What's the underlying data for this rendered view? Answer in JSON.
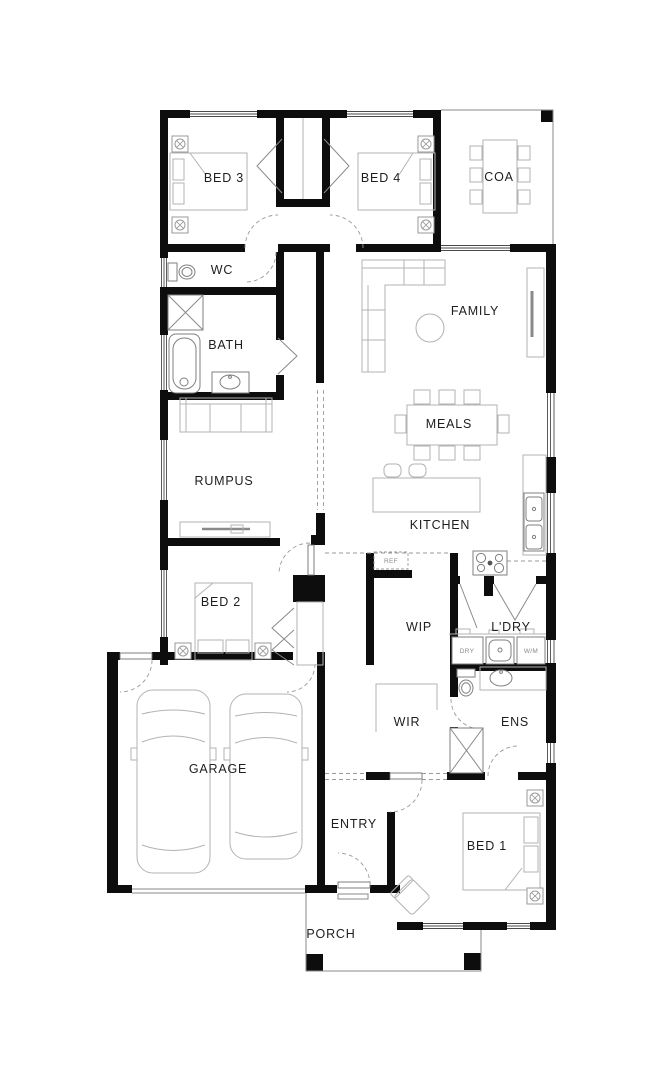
{
  "floorplan": {
    "rooms": {
      "bed3": "BED 3",
      "bed4": "BED 4",
      "coa": "COA",
      "wc": "WC",
      "bath": "BATH",
      "family": "FAMILY",
      "meals": "MEALS",
      "rumpus": "RUMPUS",
      "kitchen": "KITCHEN",
      "bed2": "BED 2",
      "wip": "WIP",
      "ldry": "L'DRY",
      "wir": "WIR",
      "ens": "ENS",
      "garage": "GARAGE",
      "entry": "ENTRY",
      "bed1": "BED 1",
      "porch": "PORCH"
    },
    "appliances": {
      "fridge": "REF",
      "dryer": "DRY",
      "washer": "W/M"
    },
    "colors": {
      "wall": "#0d0d0d",
      "furniture": "#b3b3b3",
      "background": "#ffffff",
      "dashed": "#9a9a9a"
    }
  }
}
